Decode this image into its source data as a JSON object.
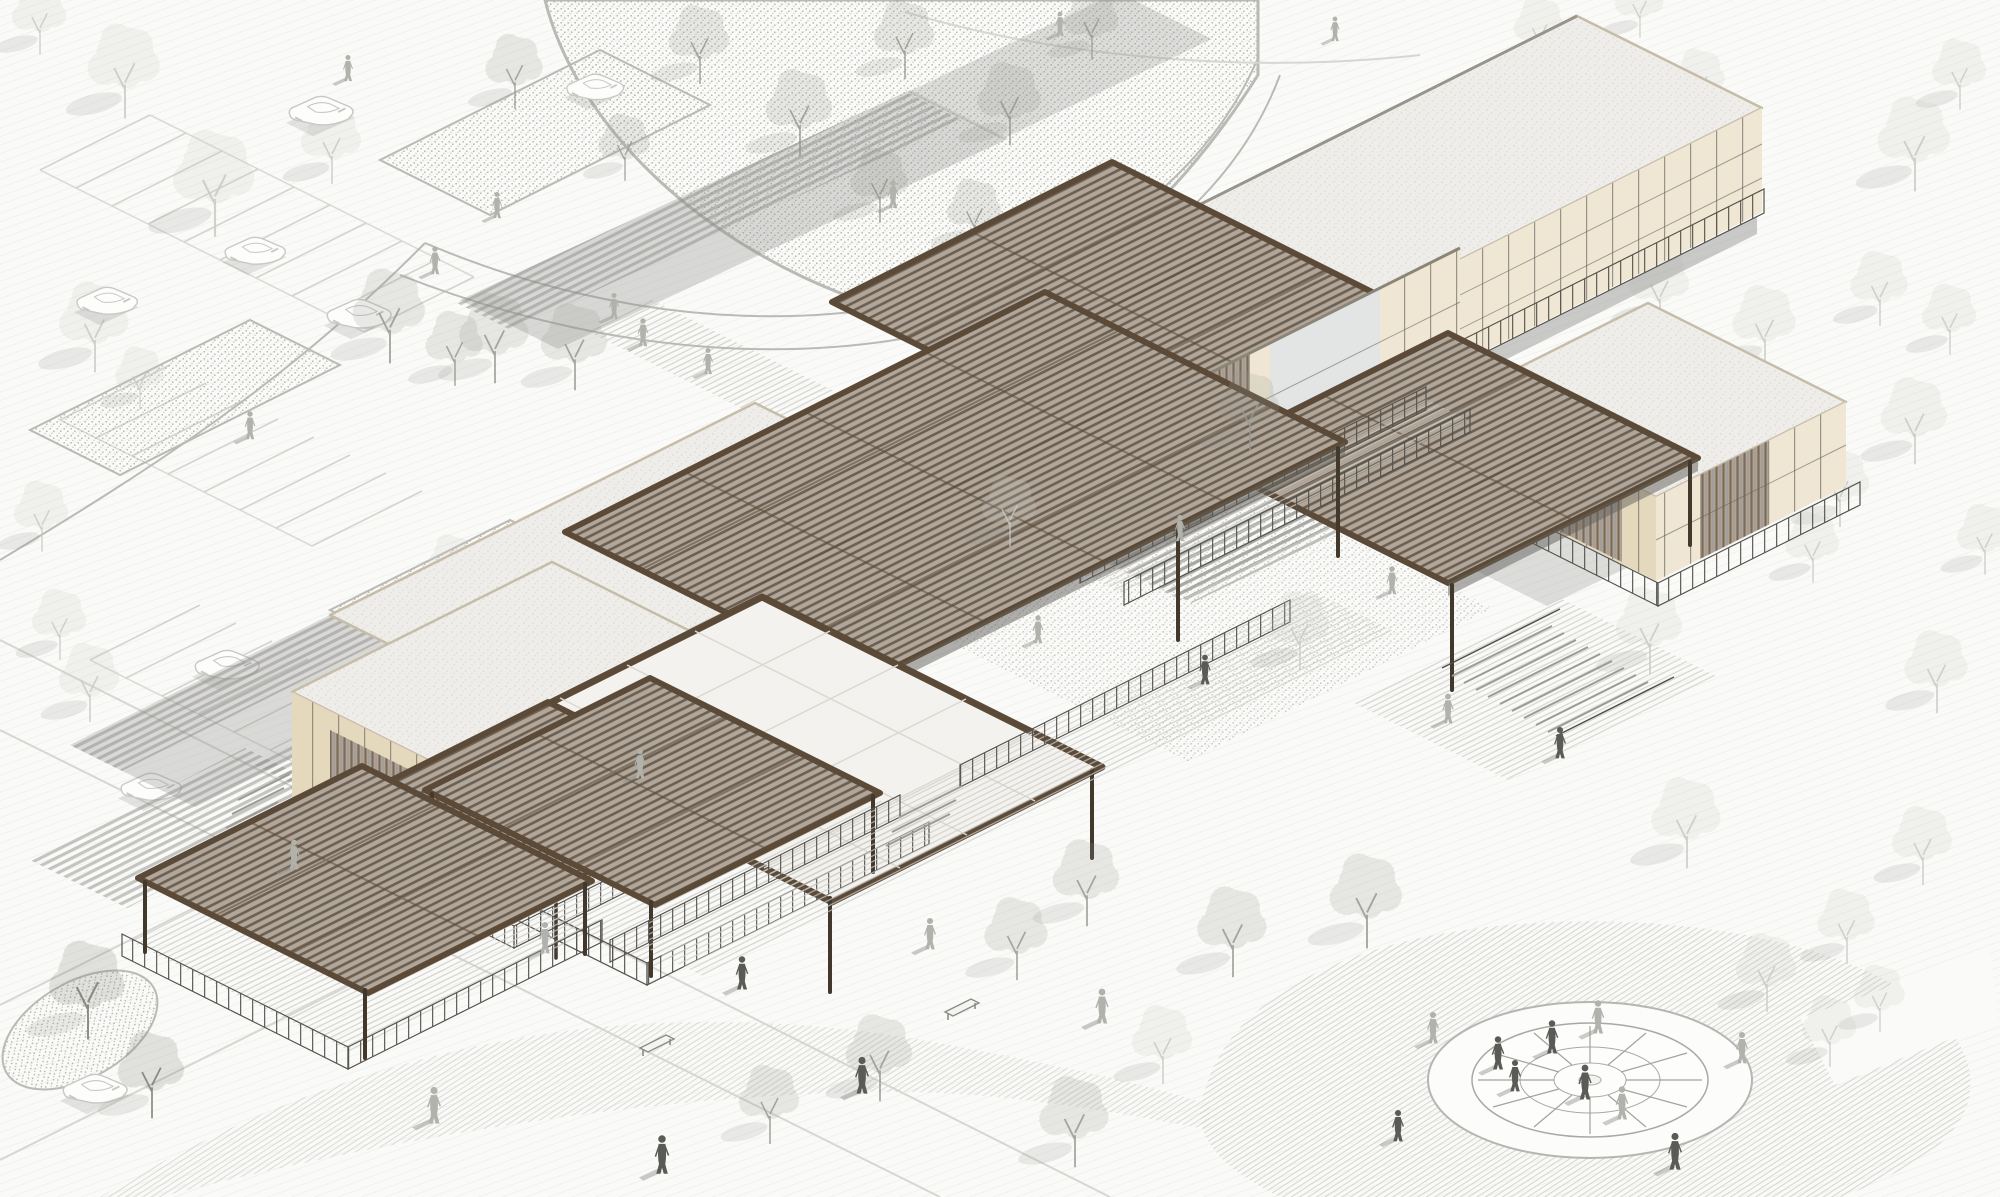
{
  "meta": {
    "title": "Architectural axonometric site rendering",
    "type": "illustration",
    "description": "Monochrome axonometric rendering of a cultural/visitor-center complex: dark wood louvered canopy roofs over cream stone-grid pavilions, a white translucent skylight canopy, decks with railings and stairs, a stippled courtyard with trees, parking lot with cars upper-left, planting beds, scattered pedestrians, and a radial circular plaza lower-right."
  },
  "colors": {
    "paper": "#fafaf8",
    "line_faint": "#d6d6d2",
    "line_mid": "#b9b9b5",
    "roof_frame": "#5c4a39",
    "louver_bg": "#b0a699",
    "louver_line": "#6c5f51",
    "roof_white": "#f3f2ee",
    "roof_white_line": "#dbd9d2",
    "speckle_bg": "#eeede9",
    "speckle_dot": "#d9d7d1",
    "parapet": "#c6bda9",
    "facade_cream": "#efe7d3",
    "facade_cream2": "#e4d8bd",
    "facade_mullion": "#6a655c",
    "glass": "#e2e5e4",
    "railing": "#54524d",
    "post": "#42382c",
    "stair_line": "#9b9b96",
    "shadow": "#8f8e8b",
    "tree_faint": "#c9c9c5",
    "tree_medium": "#9a9a94",
    "tree_dark": "#7b7b75",
    "person_dark": "#5a5a56",
    "person_light": "#b2b2ad",
    "car_line": "#c8c8c4"
  },
  "scene": {
    "counts": {
      "canopies": 8,
      "buildings": 5,
      "pavilions": 2,
      "plaza_spokes": 12
    },
    "trees_back": [
      {
        "x": 125,
        "y": 92,
        "v": "faint",
        "s": 1.2
      },
      {
        "x": 215,
        "y": 207,
        "v": "faint",
        "s": 1.35
      },
      {
        "x": 95,
        "y": 347,
        "v": "faint",
        "s": 1.15
      },
      {
        "x": 332,
        "y": 162,
        "v": "faint",
        "s": 1.0
      },
      {
        "x": 40,
        "y": 35,
        "v": "faint",
        "s": 0.9
      },
      {
        "x": 42,
        "y": 532,
        "v": "faint",
        "s": 0.9
      },
      {
        "x": 60,
        "y": 640,
        "v": "faint",
        "s": 0.9
      },
      {
        "x": 90,
        "y": 700,
        "v": "faint",
        "s": 1.0
      },
      {
        "x": 515,
        "y": 88,
        "v": "med",
        "s": 0.95
      },
      {
        "x": 625,
        "y": 162,
        "v": "med",
        "s": 0.85
      },
      {
        "x": 140,
        "y": 392,
        "v": "faint",
        "s": 0.8
      },
      {
        "x": 452,
        "y": 577,
        "v": "faint",
        "s": 0.75
      },
      {
        "x": 700,
        "y": 62,
        "v": "med",
        "s": 1.0
      },
      {
        "x": 800,
        "y": 132,
        "v": "med",
        "s": 1.1
      },
      {
        "x": 905,
        "y": 57,
        "v": "med",
        "s": 1.0
      },
      {
        "x": 1010,
        "y": 122,
        "v": "med",
        "s": 1.05
      },
      {
        "x": 1092,
        "y": 40,
        "v": "med",
        "s": 0.9
      },
      {
        "x": 880,
        "y": 202,
        "v": "med",
        "s": 0.95
      },
      {
        "x": 975,
        "y": 230,
        "v": "med",
        "s": 0.9
      },
      {
        "x": 1262,
        "y": 302,
        "v": "faint",
        "s": 1.0
      },
      {
        "x": 1360,
        "y": 392,
        "v": "faint",
        "s": 1.05
      },
      {
        "x": 1300,
        "y": 458,
        "v": "faint",
        "s": 0.95
      },
      {
        "x": 1432,
        "y": 168,
        "v": "med",
        "s": 1.1
      },
      {
        "x": 1540,
        "y": 45,
        "v": "faint",
        "s": 0.85
      },
      {
        "x": 1640,
        "y": 20,
        "v": "faint",
        "s": 0.8
      },
      {
        "x": 1595,
        "y": 142,
        "v": "faint",
        "s": 0.9
      },
      {
        "x": 1700,
        "y": 97,
        "v": "faint",
        "s": 0.85
      },
      {
        "x": 1960,
        "y": 90,
        "v": "faint",
        "s": 0.9
      },
      {
        "x": 1915,
        "y": 165,
        "v": "faint",
        "s": 1.2
      },
      {
        "x": 1660,
        "y": 305,
        "v": "faint",
        "s": 1.0
      },
      {
        "x": 1765,
        "y": 345,
        "v": "faint",
        "s": 1.05
      },
      {
        "x": 1880,
        "y": 305,
        "v": "faint",
        "s": 0.95
      },
      {
        "x": 1950,
        "y": 335,
        "v": "faint",
        "s": 0.9
      },
      {
        "x": 1705,
        "y": 415,
        "v": "faint",
        "s": 1.0
      },
      {
        "x": 1915,
        "y": 440,
        "v": "faint",
        "s": 1.1
      },
      {
        "x": 1840,
        "y": 505,
        "v": "faint",
        "s": 1.0
      },
      {
        "x": 1985,
        "y": 555,
        "v": "faint",
        "s": 0.9
      },
      {
        "x": 1650,
        "y": 650,
        "v": "faint",
        "s": 1.1
      },
      {
        "x": 1813,
        "y": 563,
        "v": "faint",
        "s": 0.9
      },
      {
        "x": 1937,
        "y": 690,
        "v": "faint",
        "s": 1.05
      },
      {
        "x": 1687,
        "y": 843,
        "v": "faint",
        "s": 1.15
      },
      {
        "x": 1923,
        "y": 863,
        "v": "faint",
        "s": 1.0
      },
      {
        "x": 1847,
        "y": 943,
        "v": "faint",
        "s": 0.95
      },
      {
        "x": 1767,
        "y": 990,
        "v": "faint",
        "s": 1.0
      },
      {
        "x": 1830,
        "y": 1047,
        "v": "faint",
        "s": 0.9
      },
      {
        "x": 1880,
        "y": 1013,
        "v": "faint",
        "s": 0.85
      },
      {
        "x": 1163,
        "y": 1062,
        "v": "faint",
        "s": 1.0
      }
    ],
    "trees_front": [
      {
        "x": 88,
        "y": 1012,
        "v": "dark",
        "s": 1.25
      },
      {
        "x": 152,
        "y": 1094,
        "v": "dark",
        "s": 1.1
      },
      {
        "x": 390,
        "y": 337,
        "v": "med",
        "s": 1.2
      },
      {
        "x": 455,
        "y": 365,
        "v": "med",
        "s": 0.95
      },
      {
        "x": 495,
        "y": 358,
        "v": "med",
        "s": 1.15
      },
      {
        "x": 575,
        "y": 366,
        "v": "med",
        "s": 1.1
      },
      {
        "x": 1017,
        "y": 957,
        "v": "med",
        "s": 1.05
      },
      {
        "x": 1087,
        "y": 902,
        "v": "med",
        "s": 1.1
      },
      {
        "x": 1233,
        "y": 952,
        "v": "med",
        "s": 1.15
      },
      {
        "x": 1367,
        "y": 922,
        "v": "med",
        "s": 1.2
      },
      {
        "x": 880,
        "y": 1077,
        "v": "med",
        "s": 1.1
      },
      {
        "x": 1075,
        "y": 1142,
        "v": "med",
        "s": 1.15
      },
      {
        "x": 770,
        "y": 1122,
        "v": "med",
        "s": 1.0
      },
      {
        "x": 1010,
        "y": 527,
        "v": "faint",
        "s": 0.9
      },
      {
        "x": 1300,
        "y": 648,
        "v": "faint",
        "s": 1.0
      },
      {
        "x": 1250,
        "y": 428,
        "v": "med",
        "s": 1.0
      }
    ],
    "cars": [
      {
        "x": 322,
        "y": 112,
        "s": 0.9
      },
      {
        "x": 256,
        "y": 252,
        "s": 0.85
      },
      {
        "x": 108,
        "y": 302,
        "s": 0.85
      },
      {
        "x": 596,
        "y": 88,
        "s": 0.8
      },
      {
        "x": 360,
        "y": 315,
        "s": 0.9
      },
      {
        "x": 228,
        "y": 666,
        "s": 0.9
      },
      {
        "x": 344,
        "y": 704,
        "s": 0.9
      },
      {
        "x": 152,
        "y": 788,
        "s": 0.85
      },
      {
        "x": 96,
        "y": 1090,
        "s": 0.9
      }
    ],
    "people": [
      {
        "x": 893,
        "y": 207,
        "v": "light",
        "s": 0.8
      },
      {
        "x": 614,
        "y": 318,
        "v": "light",
        "s": 0.75
      },
      {
        "x": 348,
        "y": 80,
        "v": "light",
        "s": 0.75
      },
      {
        "x": 250,
        "y": 438,
        "v": "light",
        "s": 0.8
      },
      {
        "x": 435,
        "y": 273,
        "v": "light",
        "s": 0.8
      },
      {
        "x": 497,
        "y": 217,
        "v": "light",
        "s": 0.75
      },
      {
        "x": 643,
        "y": 345,
        "v": "light",
        "s": 0.8
      },
      {
        "x": 708,
        "y": 373,
        "v": "light",
        "s": 0.75
      },
      {
        "x": 1060,
        "y": 35,
        "v": "light",
        "s": 0.7
      },
      {
        "x": 1335,
        "y": 40,
        "v": "light",
        "s": 0.7
      },
      {
        "x": 640,
        "y": 777,
        "v": "light",
        "s": 0.85
      },
      {
        "x": 545,
        "y": 952,
        "v": "light",
        "s": 0.9
      },
      {
        "x": 742,
        "y": 988,
        "v": "dark",
        "s": 0.95
      },
      {
        "x": 930,
        "y": 948,
        "v": "light",
        "s": 0.9
      },
      {
        "x": 862,
        "y": 1092,
        "v": "dark",
        "s": 1.05
      },
      {
        "x": 1102,
        "y": 1022,
        "v": "light",
        "s": 1.0
      },
      {
        "x": 434,
        "y": 1122,
        "v": "light",
        "s": 1.05
      },
      {
        "x": 662,
        "y": 1172,
        "v": "dark",
        "s": 1.1
      },
      {
        "x": 294,
        "y": 868,
        "v": "light",
        "s": 0.85
      },
      {
        "x": 1038,
        "y": 642,
        "v": "light",
        "s": 0.8
      },
      {
        "x": 1205,
        "y": 683,
        "v": "dark",
        "s": 0.85
      },
      {
        "x": 1392,
        "y": 593,
        "v": "light",
        "s": 0.8
      },
      {
        "x": 1448,
        "y": 722,
        "v": "light",
        "s": 0.85
      },
      {
        "x": 1560,
        "y": 757,
        "v": "dark",
        "s": 0.9
      },
      {
        "x": 1180,
        "y": 540,
        "v": "light",
        "s": 0.75
      },
      {
        "x": 1598,
        "y": 1032,
        "v": "light",
        "s": 0.95
      },
      {
        "x": 1433,
        "y": 1042,
        "v": "light",
        "s": 0.9
      },
      {
        "x": 1498,
        "y": 1068,
        "v": "dark",
        "s": 0.95
      },
      {
        "x": 1515,
        "y": 1090,
        "v": "dark",
        "s": 0.9
      },
      {
        "x": 1552,
        "y": 1052,
        "v": "dark",
        "s": 0.95
      },
      {
        "x": 1585,
        "y": 1098,
        "v": "dark",
        "s": 1.0
      },
      {
        "x": 1622,
        "y": 1118,
        "v": "light",
        "s": 0.95
      },
      {
        "x": 1675,
        "y": 1168,
        "v": "dark",
        "s": 1.05
      },
      {
        "x": 1398,
        "y": 1140,
        "v": "dark",
        "s": 0.9
      },
      {
        "x": 1742,
        "y": 1062,
        "v": "light",
        "s": 0.9
      }
    ],
    "benches": [
      {
        "x": 945,
        "y": 1012
      },
      {
        "x": 640,
        "y": 1048
      }
    ]
  }
}
